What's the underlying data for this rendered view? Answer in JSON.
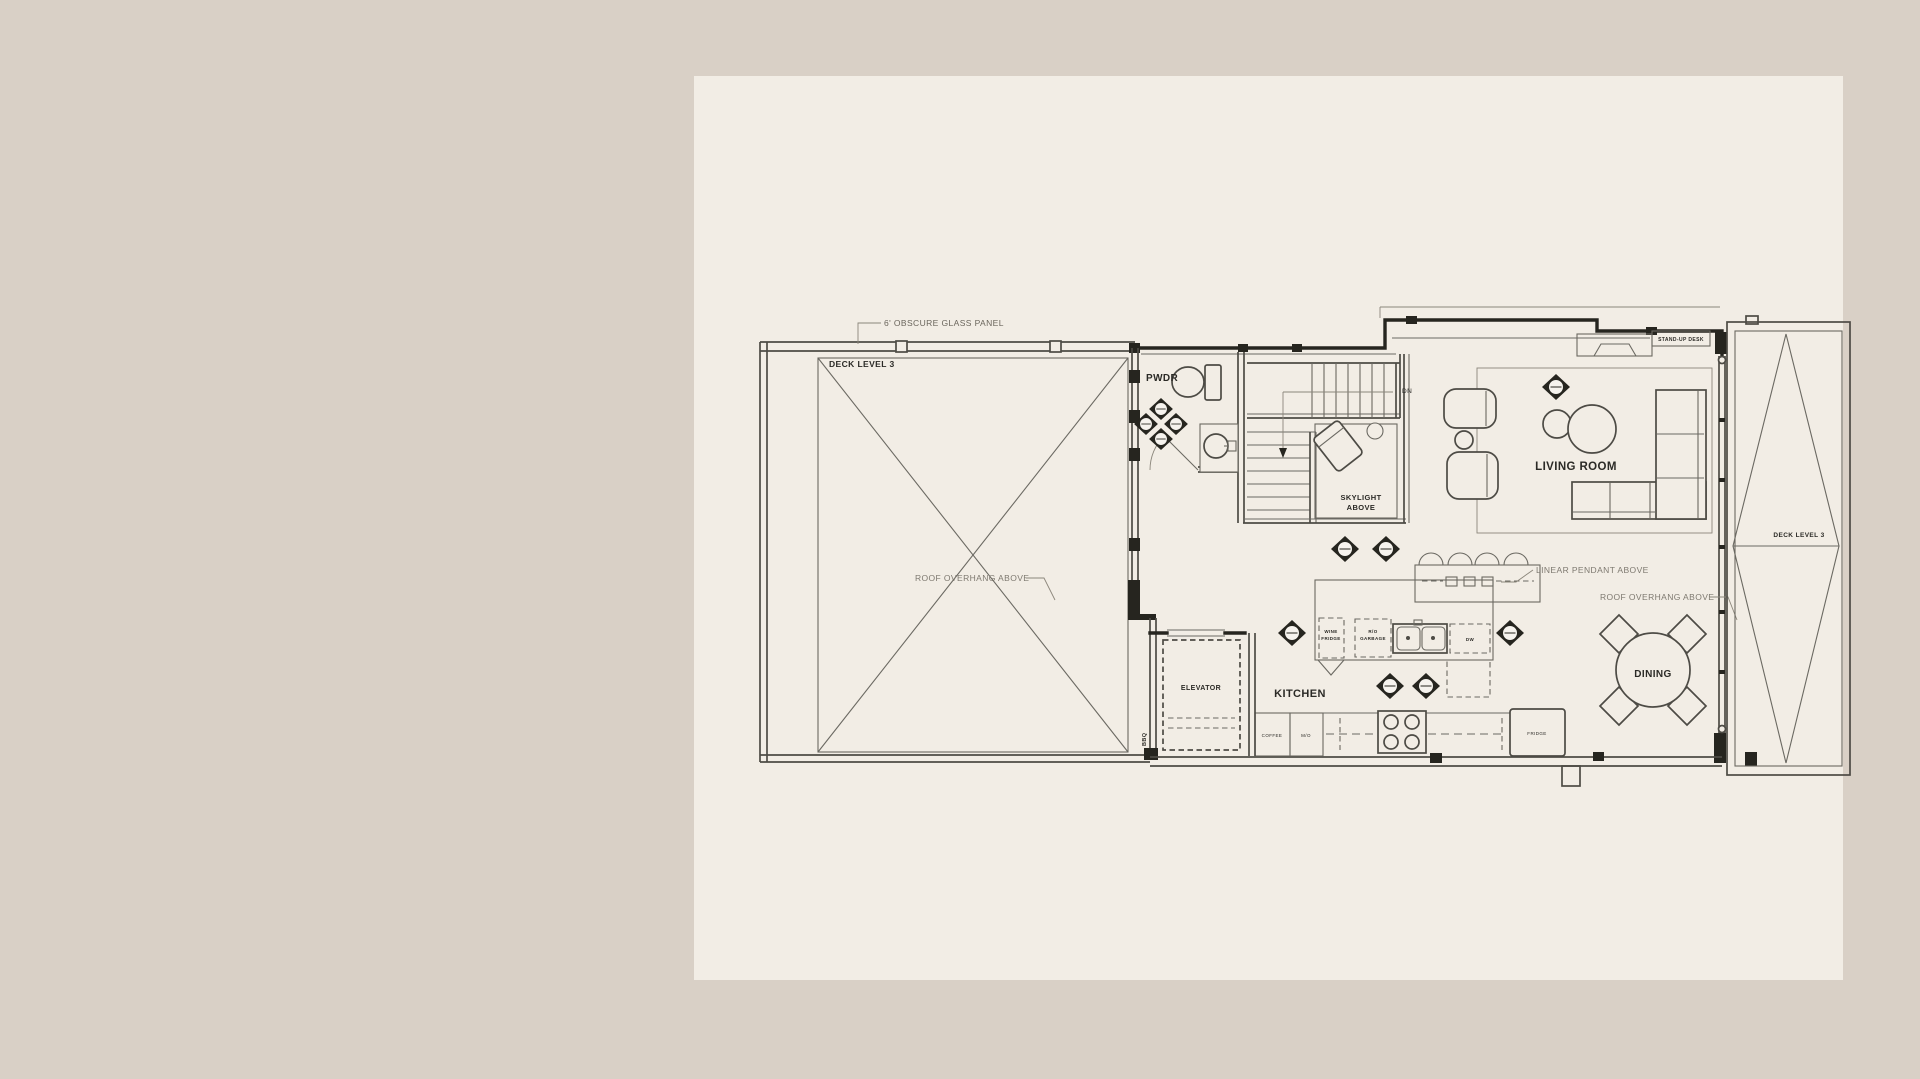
{
  "colors": {
    "background": "#d9d0c6",
    "paper": "#f2ede5",
    "wall": "#26251f",
    "line": "#4d4b45",
    "light_line": "#8b867b",
    "text_dark": "#2b2a26",
    "text_light": "#7e7970"
  },
  "labels": {
    "deck_left": "DECK LEVEL 3",
    "deck_right": "DECK LEVEL 3",
    "pwdr": "PWDR",
    "living_room": "LIVING ROOM",
    "kitchen": "KITCHEN",
    "dining": "DINING",
    "elevator": "ELEVATOR",
    "skylight_1": "SKYLIGHT",
    "skylight_2": "ABOVE",
    "dn": "DN",
    "bbq": "BBQ",
    "stand_up_desk": "STAND-UP DESK",
    "glass_panel": "6' OBSCURE GLASS PANEL",
    "roof_overhang_left": "ROOF OVERHANG ABOVE",
    "roof_overhang_right": "ROOF OVERHANG ABOVE",
    "linear_pendant": "LINEAR PENDANT ABOVE",
    "wine_1": "WINE",
    "wine_2": "FRIDGE",
    "ro_1": "R/O",
    "ro_2": "GARBAGE",
    "dw": "DW",
    "coffee": "COFFEE",
    "mo": "M/O",
    "fridge": "FRIDGE"
  }
}
